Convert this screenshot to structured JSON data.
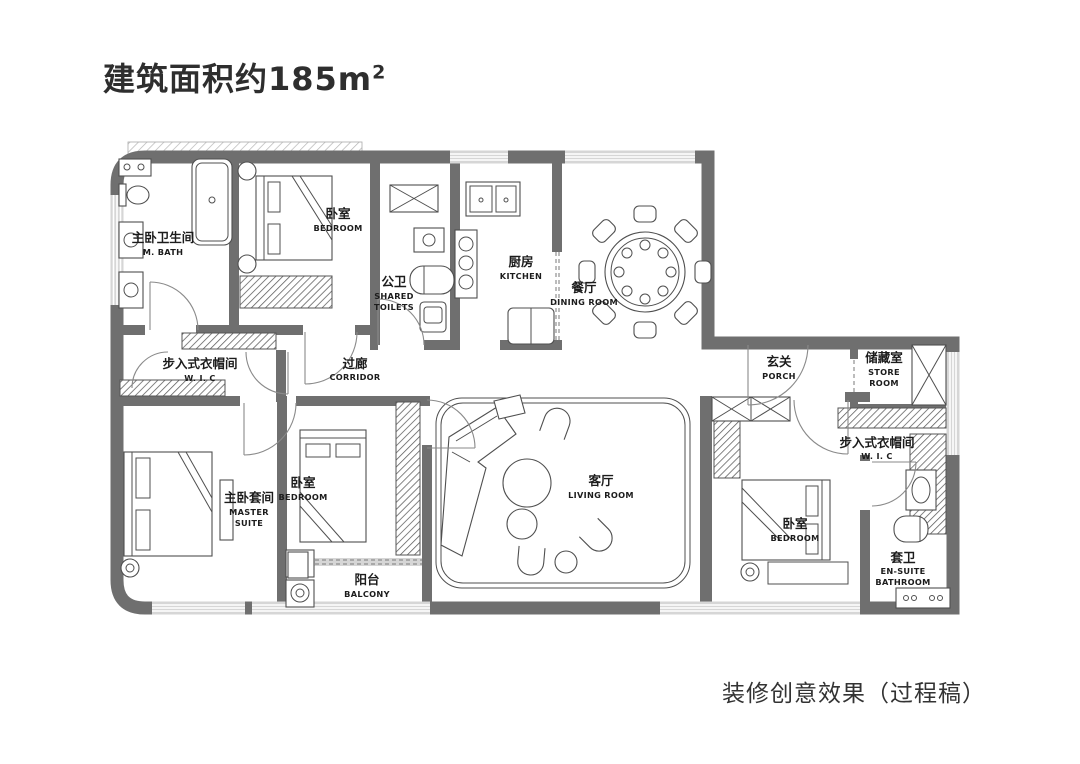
{
  "title": {
    "main": "建筑面积约185m",
    "sup": "2"
  },
  "caption": "装修创意效果（过程稿）",
  "colors": {
    "wall": "#6f6f6f",
    "window": "#d6d6d6",
    "furniture_line": "#4f4f4f",
    "text": "#1c1c1c",
    "background": "#ffffff"
  },
  "rooms": {
    "master_bath": {
      "cn": "主卧卫生间",
      "en": "M. BATH"
    },
    "bedroom_top": {
      "cn": "卧室",
      "en": "BEDROOM"
    },
    "shared_toilet": {
      "cn": "公卫",
      "en1": "SHARED",
      "en2": "TOILETS"
    },
    "kitchen": {
      "cn": "厨房",
      "en": "KITCHEN"
    },
    "dining": {
      "cn": "餐厅",
      "en": "DINING ROOM"
    },
    "porch": {
      "cn": "玄关",
      "en": "PORCH"
    },
    "store": {
      "cn": "储藏室",
      "en1": "STORE",
      "en2": "ROOM"
    },
    "wic_right": {
      "cn": "步入式衣帽间",
      "en": "W. I. C"
    },
    "wic_left": {
      "cn": "步入式衣帽间",
      "en": "W. I. C"
    },
    "corridor": {
      "cn": "过廊",
      "en": "CORRIDOR"
    },
    "master_suite": {
      "cn": "主卧套间",
      "en1": "MASTER",
      "en2": "SUITE"
    },
    "bedroom_mid": {
      "cn": "卧室",
      "en": "BEDROOM"
    },
    "living": {
      "cn": "客厅",
      "en": "LIVING ROOM"
    },
    "balcony": {
      "cn": "阳台",
      "en": "BALCONY"
    },
    "bedroom_right": {
      "cn": "卧室",
      "en": "BEDROOM"
    },
    "ensuite": {
      "cn": "套卫",
      "en1": "EN-SUITE",
      "en2": "BATHROOM"
    }
  }
}
